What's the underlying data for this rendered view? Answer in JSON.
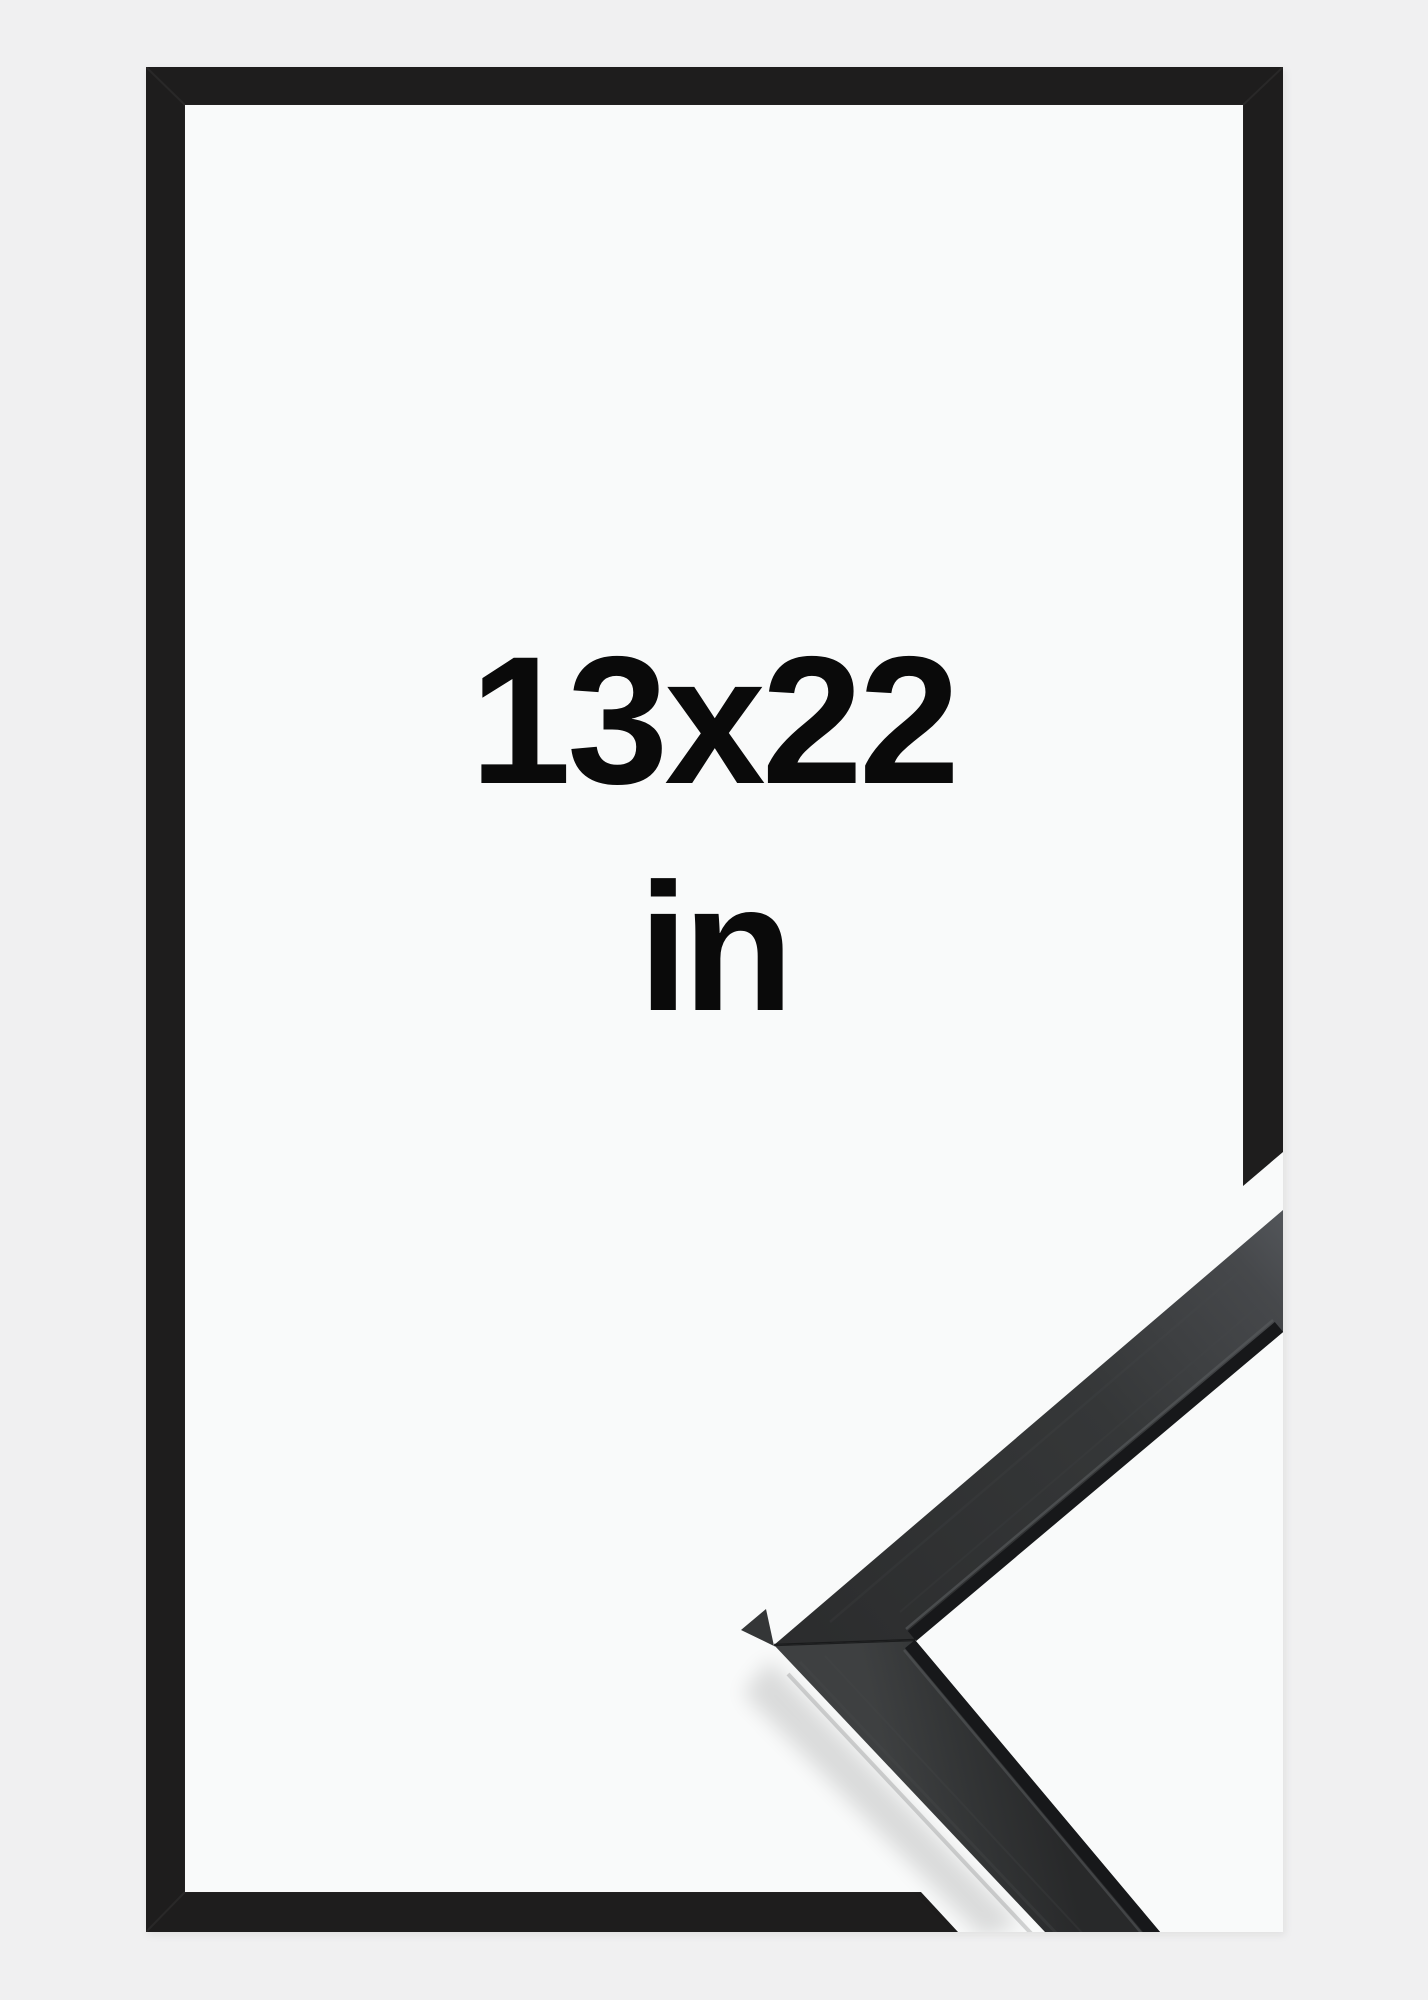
{
  "product_image": {
    "size_label": "13x22",
    "unit_label": "in"
  },
  "icons": {
    "frame_front_view": "black-picture-frame-outline",
    "corner_detail": "frame-corner-profile-closeup"
  },
  "colors": {
    "background": "#f0f0f1",
    "opening": "#f9fafa",
    "frame": "#1e1d1d",
    "text": "#0a0a0a",
    "detail_dark": "#2b2c2d",
    "detail_light": "#53565a"
  }
}
